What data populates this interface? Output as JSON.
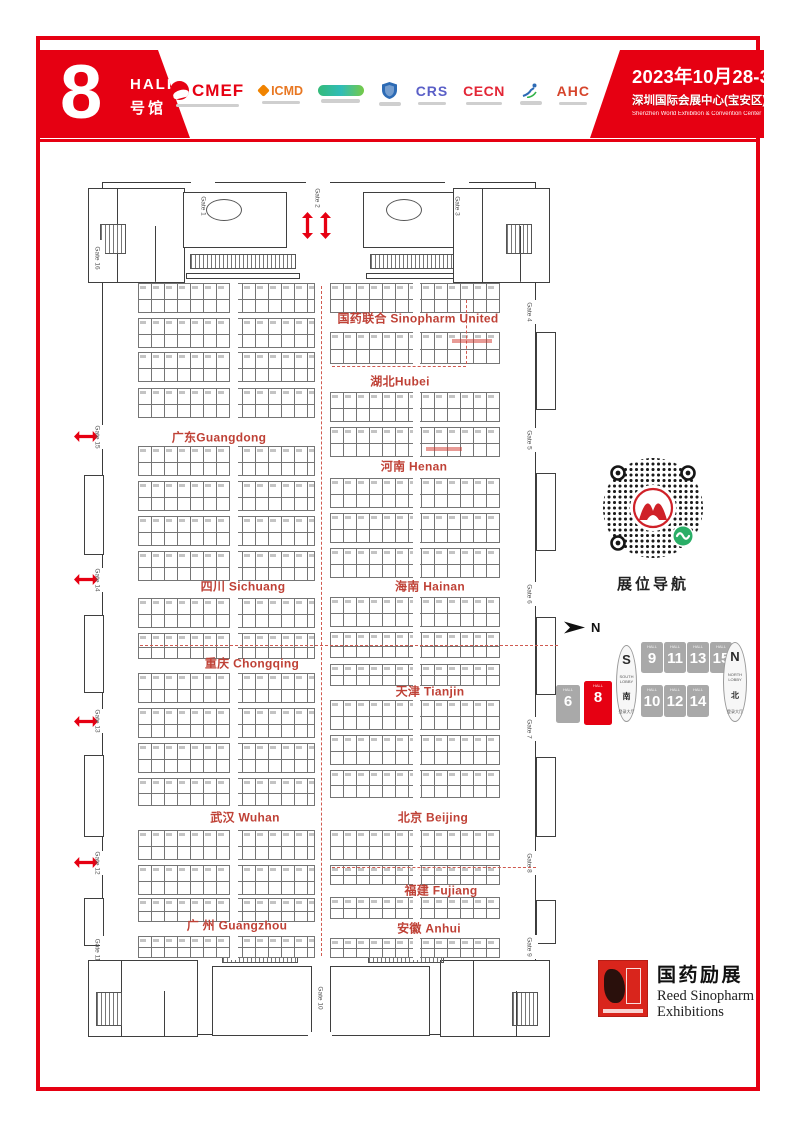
{
  "header": {
    "hall": {
      "number": "8",
      "en": "HALL",
      "cn": "号馆"
    },
    "logos": {
      "cmef": "CMEF",
      "icmd": "ICMD",
      "crs": "CRS",
      "cecn": "CECN",
      "ahc": "AHC"
    },
    "event": {
      "date": "2023年10月28-31日",
      "venue_cn": "深圳国际会展中心(宝安区)",
      "venue_en": "Shenzhen World Exhibition & Convention Center"
    }
  },
  "floorplan": {
    "regions": [
      {
        "label": "国药联合 Sinopharm United"
      },
      {
        "label": "湖北Hubei"
      },
      {
        "label": "广东Guangdong"
      },
      {
        "label": "河南 Henan"
      },
      {
        "label": "四川 Sichuang"
      },
      {
        "label": "海南  Hainan"
      },
      {
        "label": "重庆 Chongqing"
      },
      {
        "label": "天津  Tianjin"
      },
      {
        "label": "武汉  Wuhan"
      },
      {
        "label": "北京  Beijing"
      },
      {
        "label": "福建 Fujiang"
      },
      {
        "label": "广 州 Guangzhou"
      },
      {
        "label": "安徽 Anhui"
      }
    ],
    "gates": [
      "Gate 1",
      "Gate 2",
      "Gate 3",
      "Gate 4",
      "Gate 5",
      "Gate 6",
      "Gate 7",
      "Gate 8",
      "Gate 9",
      "Gate 10",
      "Gate 11",
      "Gate 12",
      "Gate 13",
      "Gate 14",
      "Gate 15",
      "Gate 16"
    ]
  },
  "sidebar": {
    "qr_label": "展位导航",
    "compass_label": "N",
    "minimap": {
      "hall_caption": "HALL",
      "halls": [
        "6",
        "8",
        "9",
        "10",
        "11",
        "12",
        "13",
        "14",
        "15"
      ],
      "active_hall": "8",
      "south_lobby": {
        "letter": "S",
        "en": "SOUTH LOBBY",
        "cn": "南",
        "cn_sub": "登录大厅"
      },
      "north_lobby": {
        "letter": "N",
        "en": "NORTH LOBBY",
        "cn": "北",
        "cn_sub": "登录大厅"
      }
    }
  },
  "footer": {
    "logo": {
      "cn": "国药励展",
      "en1": "Reed Sinopharm",
      "en2": "Exhibitions"
    }
  },
  "colors": {
    "brand_red": "#e60012",
    "region_red": "#bf4136",
    "map_gray": "#a9a9a9"
  }
}
